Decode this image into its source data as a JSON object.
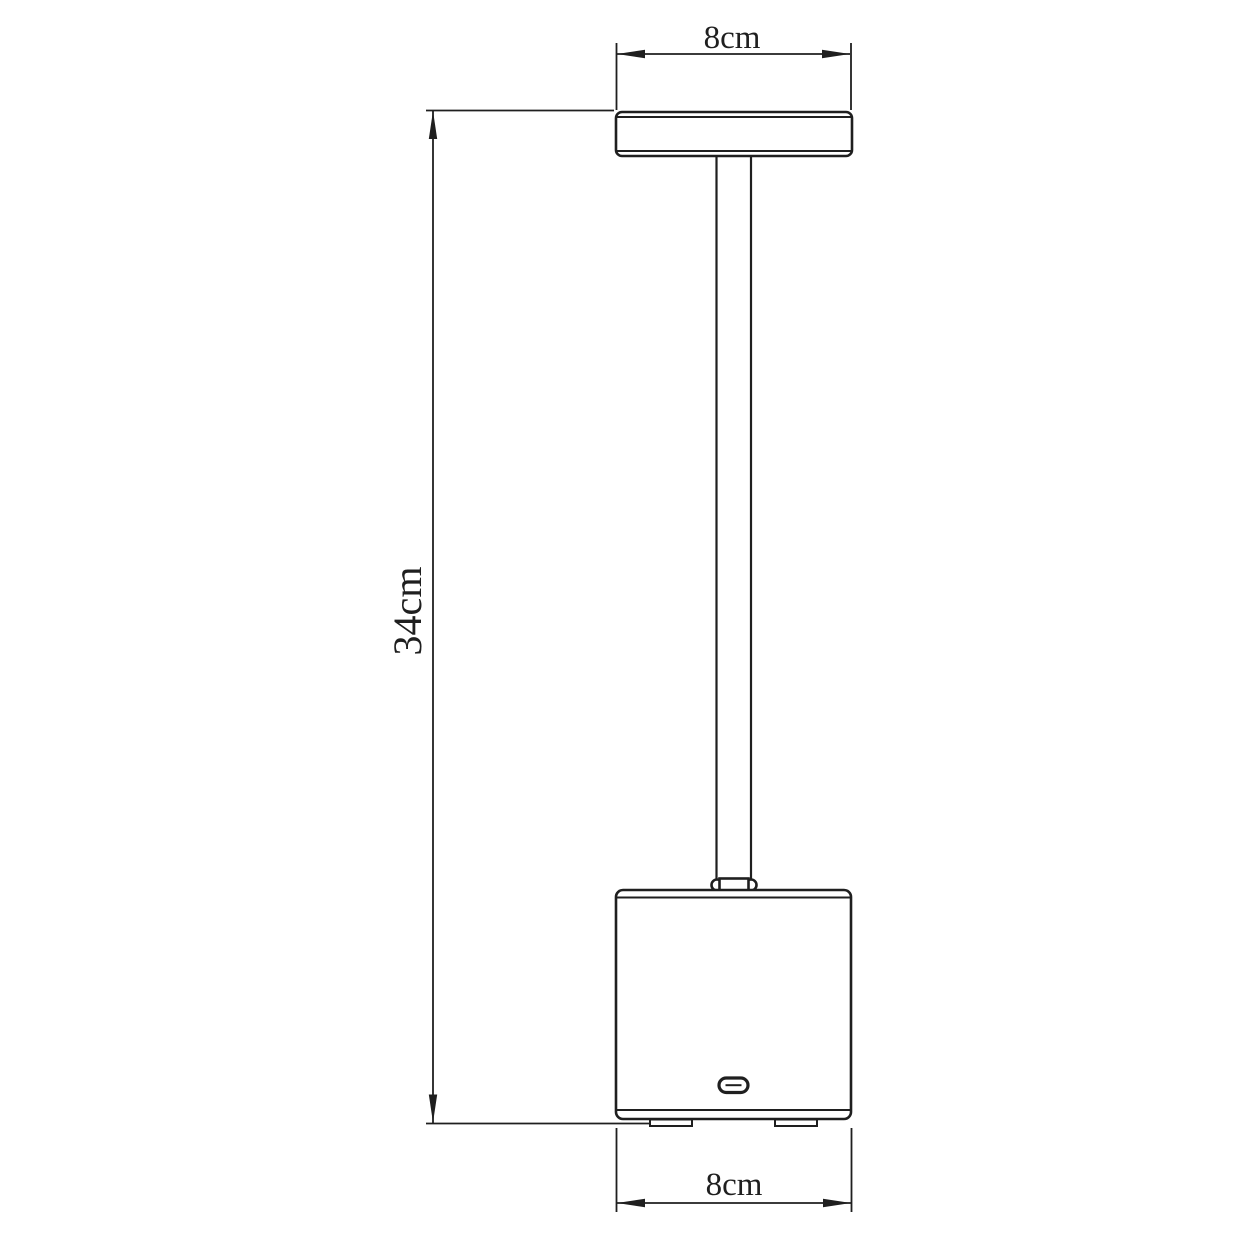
{
  "diagram": {
    "background_color": "#ffffff",
    "line_color": "#1f1f1f",
    "dimensions": {
      "top_width": {
        "label": "8cm",
        "value_cm": 8,
        "orientation": "horizontal"
      },
      "height": {
        "label": "34cm",
        "value_cm": 34,
        "orientation": "vertical"
      },
      "base_width": {
        "label": "8cm",
        "value_cm": 8,
        "orientation": "horizontal"
      }
    }
  }
}
